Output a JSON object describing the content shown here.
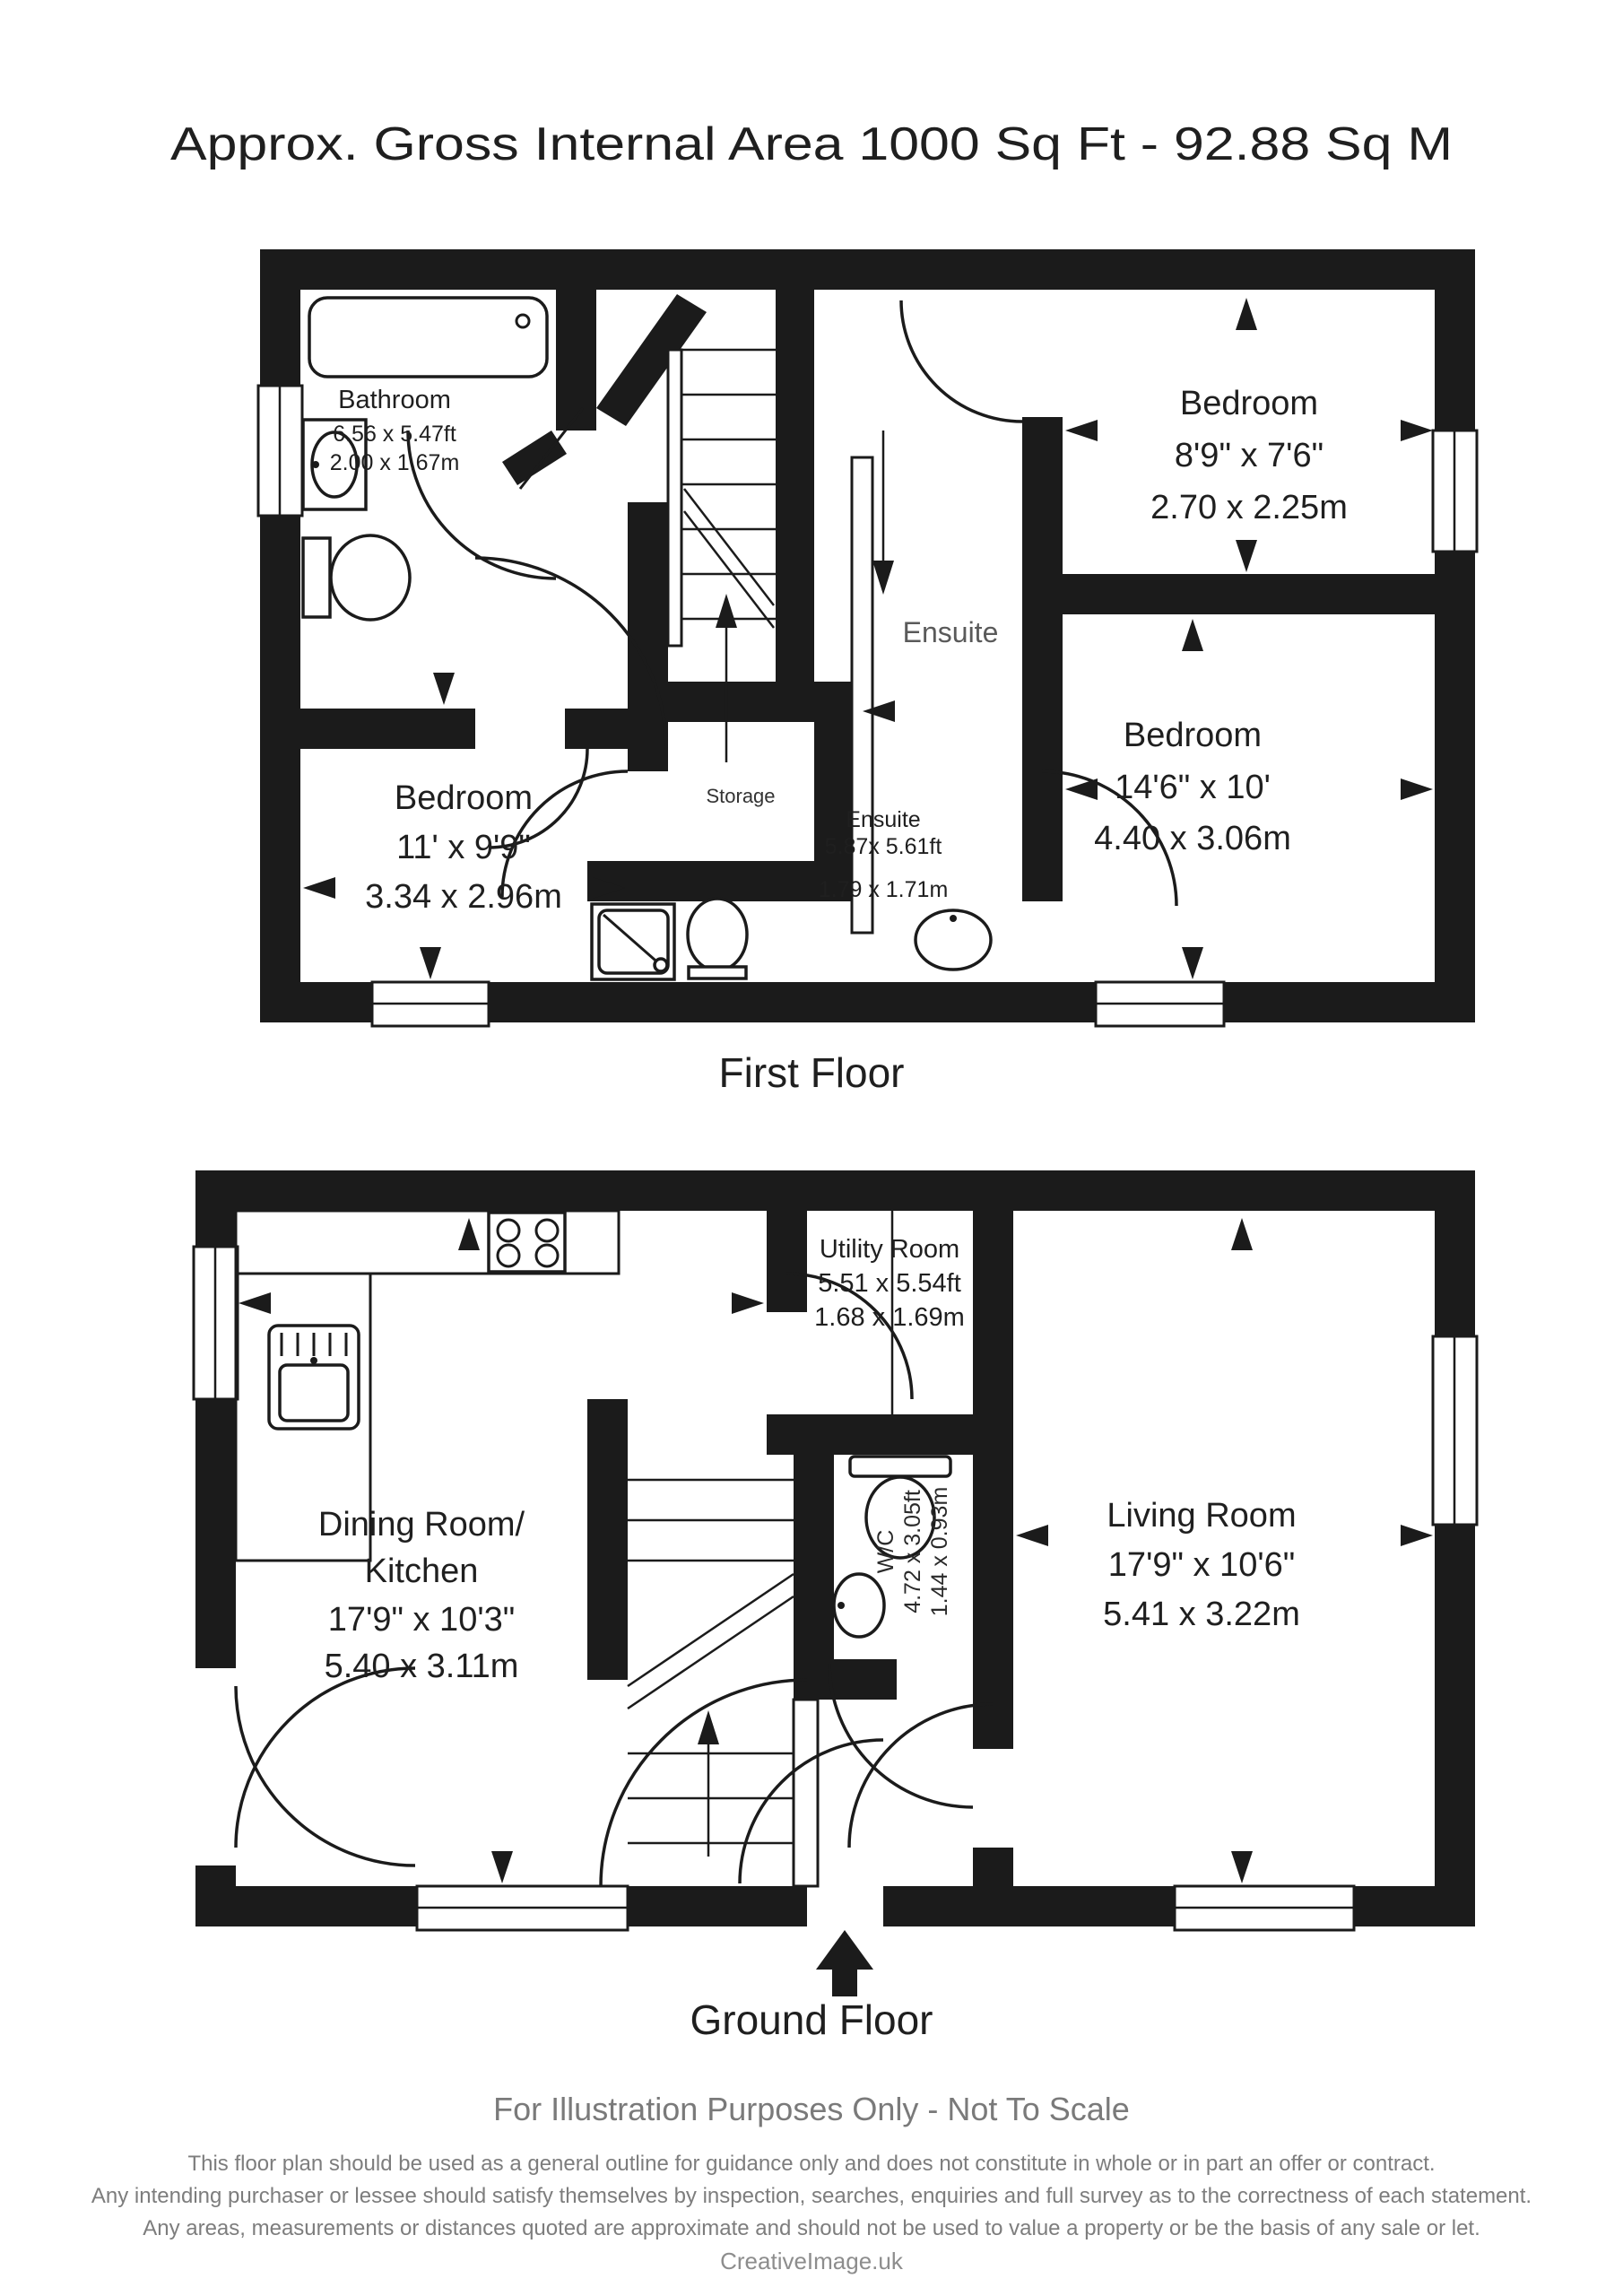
{
  "title": "Approx. Gross Internal Area   1000 Sq Ft  -  92.88 Sq M",
  "colors": {
    "ink": "#1b1b1b",
    "ensuite_gray": "#5a5a5a",
    "footer_gray": "#7a7a7a"
  },
  "floors": {
    "first": {
      "label": "First Floor",
      "rooms": {
        "bathroom": {
          "name": "Bathroom",
          "dims_ft": "6.56 x 5.47ft",
          "dims_m": "2.00 x 1.67m"
        },
        "bedroom_topright": {
          "name": "Bedroom",
          "dims_ft": "8'9\" x 7'6\"",
          "dims_m": "2.70 x 2.25m"
        },
        "bedroom_left": {
          "name": "Bedroom",
          "dims_ft": "11' x 9'9\"",
          "dims_m": "3.34 x 2.96m"
        },
        "bedroom_right": {
          "name": "Bedroom",
          "dims_ft": "14'6\" x 10'",
          "dims_m": "4.40 x 3.06m"
        },
        "ensuite_big": {
          "name": "Ensuite"
        },
        "storage": {
          "name": "Storage"
        },
        "ensuite_small": {
          "name": "Ensuite",
          "dims_ft": "5.87x 5.61ft",
          "dims_m": "1.79 x 1.71m"
        }
      }
    },
    "ground": {
      "label": "Ground Floor",
      "rooms": {
        "utility": {
          "name": "Utility Room",
          "dims_ft": "5.51 x 5.54ft",
          "dims_m": "1.68 x 1.69m"
        },
        "dining": {
          "name_line1": "Dining Room/",
          "name_line2": "Kitchen",
          "dims_ft": "17'9\" x 10'3\"",
          "dims_m": "5.40 x 3.11m"
        },
        "living": {
          "name": "Living Room",
          "dims_ft": "17'9\" x 10'6\"",
          "dims_m": "5.41 x 3.22m"
        },
        "wc": {
          "name": "W/C",
          "dims_ft": "4.72 x 3.05ft",
          "dims_m": "1.44 x 0.93m"
        }
      }
    }
  },
  "footer": {
    "notice": "For Illustration Purposes Only - Not To Scale",
    "disclaimer_line1": "This floor plan should be used as a general outline for guidance only and does not constitute in whole or in part an offer or contract.",
    "disclaimer_line2": "Any intending purchaser or lessee should satisfy themselves by inspection, searches, enquiries and full survey as to the correctness of each statement.",
    "disclaimer_line3": "Any areas, measurements or distances quoted are approximate and should not be used to value a property or be the basis of any sale or let.",
    "brand": "CreativeImage.uk"
  }
}
